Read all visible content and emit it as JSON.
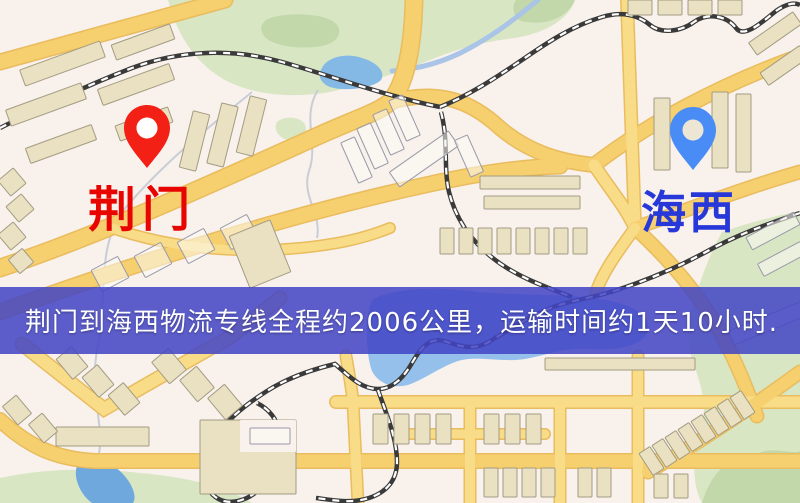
{
  "banner": {
    "text": "荆门到海西物流专线全程约2006公里，运输时间约1天10小时.",
    "bg": "rgba(66,69,197,0.86)"
  },
  "labels": {
    "origin": "荆门",
    "destination": "海西"
  },
  "colors": {
    "bg": "#f8f1ec",
    "origin_label": "#e80500",
    "destination_label": "#2838d8",
    "origin_pin": "#f32015",
    "origin_pin_hole": "#ffffff",
    "destination_pin": "#4a8cf5",
    "destination_pin_hole": "#eee6d4",
    "road_edge": "#e9bc5e",
    "road_main": "#f6cf6e",
    "road_fill": "#f9dc88",
    "rail_dark": "#3a3a3a",
    "rail_light": "#ffffff",
    "green": "#d8e6c4",
    "green_dark": "#c2d8aa",
    "water": "#96c0ec",
    "water_dark": "#6fa8dc",
    "pond": "#84b9e6",
    "river": "#a9c4e6",
    "stream": "#c9cdd6",
    "building": "#eae0c2",
    "building_edge": "#a39c82",
    "building_outline": "#9a99a8",
    "building_outline_fill": "rgba(252,250,244,0.55)"
  },
  "map_features": {
    "green": [
      {
        "d": "M168,0 L575,0 C568,22 540,34 515,38 C480,42 455,50 430,60 C400,72 365,84 330,92 C295,98 255,96 225,80 C200,66 178,40 168,0 Z",
        "fill": "green"
      },
      {
        "d": "M516,0 L575,0 C568,17 546,27 521,21 C512,15 512,5 516,0 Z",
        "fill": "green_dark"
      },
      {
        "d": "M266,20 C280,12 320,12 334,22 C344,30 340,42 322,46 C300,50 272,46 264,36 C260,30 260,25 266,20 Z",
        "fill": "green_dark"
      },
      {
        "d": "M722,232 C750,222 780,215 800,211 L800,503 L702,503 C690,480 694,452 701,430 C709,405 699,380 691,355 C685,332 691,305 701,280 C707,262 714,247 722,232 Z",
        "fill": "green"
      },
      {
        "d": "M702,503 C712,470 731,455 748,462 C764,441 789,456 800,451 L800,503 Z",
        "fill": "green_dark"
      },
      {
        "d": "M0,478 C40,469 90,467 140,473 C185,477 226,486 252,503 L0,503 Z",
        "fill": "green"
      },
      {
        "d": "M277,122 C284,116 298,116 304,123 C309,130 304,139 292,140 C281,141 272,130 277,122 Z",
        "fill": "green"
      }
    ],
    "water": [
      {
        "d": "M372,300 C390,289 430,286 470,291 C510,296 560,293 600,299 C635,304 652,317 648,331 C642,347 615,351 592,349 C565,347 548,355 525,359 C500,363 478,355 458,361 C440,367 425,379 408,385 C392,389 378,383 372,371 C366,355 364,318 372,300 Z",
        "fill": "water"
      },
      {
        "d": "M322,68 C328,56 348,53 362,58 C376,62 386,71 381,80 C371,90 336,92 326,85 C319,80 318,74 322,68 Z",
        "fill": "pond"
      },
      {
        "d": "M78,464 C90,456 110,461 121,472 C133,484 137,497 133,503 L92,503 C79,494 72,474 78,464 Z",
        "fill": "water_dark"
      }
    ],
    "river": {
      "d": "M538,0 C516,18 496,34 468,49 C446,61 420,69 392,71",
      "w": 5
    },
    "streams": [
      {
        "d": "M252,92 C205,130 160,166 122,212 C96,250 108,300 97,350 C89,398 106,428 98,458"
      },
      {
        "d": "M318,90 C301,117 319,144 309,171 C301,196 322,214 317,238"
      }
    ],
    "roads": [
      {
        "d": "M0,62 L225,0",
        "w": 14,
        "main": 1
      },
      {
        "d": "M0,268 C100,235 220,180 320,135 C360,117 380,112 392,100 C408,78 413,40 414,0",
        "w": 16,
        "main": 1
      },
      {
        "d": "M390,102 C440,88 472,102 500,128 C526,150 555,161 594,165",
        "w": 13,
        "main": 1
      },
      {
        "d": "M594,165 C650,122 722,84 800,56",
        "w": 13,
        "main": 1
      },
      {
        "d": "M594,165 C612,192 626,208 635,228",
        "w": 11,
        "main": 0
      },
      {
        "d": "M627,0 L635,228",
        "w": 11,
        "main": 0
      },
      {
        "d": "M635,228 C690,209 750,186 800,172",
        "w": 12,
        "main": 1
      },
      {
        "d": "M635,228 C672,262 700,296 720,332 C738,365 748,392 757,416",
        "w": 12,
        "main": 1
      },
      {
        "d": "M635,228 C616,254 603,272 596,292",
        "w": 10,
        "main": 0
      },
      {
        "d": "M0,312 C150,258 300,212 430,184 C480,173 525,167 560,166",
        "w": 14,
        "main": 1
      },
      {
        "d": "M22,344 L104,409 L230,337 C252,321 266,309 280,298",
        "w": 12,
        "main": 0
      },
      {
        "d": "M0,420 C28,446 55,459 95,461 L800,461",
        "w": 13,
        "main": 1
      },
      {
        "d": "M336,402 L800,402",
        "w": 11,
        "main": 0
      },
      {
        "d": "M346,356 C350,380 352,390 353,402 L358,503",
        "w": 10,
        "main": 0
      },
      {
        "d": "M470,402 L470,503",
        "w": 10,
        "main": 0
      },
      {
        "d": "M560,402 L560,503",
        "w": 10,
        "main": 0
      },
      {
        "d": "M638,356 L638,503",
        "w": 10,
        "main": 0
      },
      {
        "d": "M400,434 L545,434",
        "w": 9,
        "main": 0
      },
      {
        "d": "M648,472 C700,442 748,410 800,372",
        "w": 12,
        "main": 1
      },
      {
        "d": "M112,228 C170,248 235,254 300,248 C340,244 365,238 390,228",
        "w": 9,
        "main": 0
      }
    ],
    "railways": [
      {
        "d": "M0,128 C40,108 85,86 132,68 C180,50 232,48 282,62 C332,76 385,96 440,107"
      },
      {
        "d": "M440,107 C472,94 498,76 522,60 C548,42 572,26 602,17 C622,11 638,15 650,25 C661,34 680,32 694,22 C708,12 727,16 736,28 C744,39 762,22 776,11 C786,4 794,2 800,5"
      },
      {
        "d": "M441,112 C449,142 443,166 449,192 C456,220 472,242 494,259 C517,277 546,287 572,297"
      },
      {
        "d": "M800,213 C768,224 738,234 704,253 C676,268 648,280 614,291 C589,299 564,301 544,311 C521,321 504,333 487,343 C471,351 457,345 444,341 C429,337 420,349 412,363 C404,377 393,389 378,389 C361,389 349,376 335,364 C314,369 289,377 267,391 C245,405 225,421 211,443 C199,463 199,481 213,495 C227,508 248,501 262,487 C276,473 284,453 280,433 C277,419 269,409 257,403"
      },
      {
        "d": "M378,390 C388,418 397,440 397,462 C397,480 387,492 369,498 C351,504 333,500 316,498"
      }
    ],
    "buildings": [
      {
        "x": 20,
        "y": 55,
        "w": 85,
        "h": 17,
        "r": -20,
        "s": "A"
      },
      {
        "x": 112,
        "y": 34,
        "w": 62,
        "h": 16,
        "r": -20,
        "s": "A"
      },
      {
        "x": 6,
        "y": 96,
        "w": 80,
        "h": 17,
        "r": -20,
        "s": "A"
      },
      {
        "x": 98,
        "y": 76,
        "w": 76,
        "h": 17,
        "r": -20,
        "s": "A"
      },
      {
        "x": 26,
        "y": 136,
        "w": 70,
        "h": 16,
        "r": -20,
        "s": "A"
      },
      {
        "x": 116,
        "y": 116,
        "w": 56,
        "h": 16,
        "r": -20,
        "s": "A"
      },
      {
        "x": 2,
        "y": 172,
        "w": 20,
        "h": 20,
        "r": -40,
        "s": "A"
      },
      {
        "x": 10,
        "y": 198,
        "w": 20,
        "h": 20,
        "r": -40,
        "s": "A"
      },
      {
        "x": 2,
        "y": 226,
        "w": 20,
        "h": 20,
        "r": -40,
        "s": "A"
      },
      {
        "x": 12,
        "y": 252,
        "w": 18,
        "h": 18,
        "r": -40,
        "s": "A"
      },
      {
        "x": 186,
        "y": 112,
        "w": 17,
        "h": 58,
        "r": 14,
        "s": "A"
      },
      {
        "x": 214,
        "y": 104,
        "w": 17,
        "h": 62,
        "r": 14,
        "s": "A"
      },
      {
        "x": 243,
        "y": 97,
        "w": 17,
        "h": 58,
        "r": 14,
        "s": "A"
      },
      {
        "x": 349,
        "y": 138,
        "w": 15,
        "h": 44,
        "r": -24,
        "s": "B"
      },
      {
        "x": 365,
        "y": 124,
        "w": 15,
        "h": 44,
        "r": -24,
        "s": "B"
      },
      {
        "x": 381,
        "y": 110,
        "w": 15,
        "h": 44,
        "r": -24,
        "s": "B"
      },
      {
        "x": 397,
        "y": 96,
        "w": 15,
        "h": 44,
        "r": -24,
        "s": "B"
      },
      {
        "x": 388,
        "y": 150,
        "w": 72,
        "h": 18,
        "r": -35,
        "s": "B"
      },
      {
        "x": 462,
        "y": 136,
        "w": 14,
        "h": 40,
        "r": -24,
        "s": "B"
      },
      {
        "x": 480,
        "y": 176,
        "w": 100,
        "h": 13,
        "r": 0,
        "s": "A"
      },
      {
        "x": 484,
        "y": 196,
        "w": 96,
        "h": 13,
        "r": 0,
        "s": "A"
      },
      {
        "x": 440,
        "y": 228,
        "w": 14,
        "h": 26,
        "r": 0,
        "s": "A"
      },
      {
        "x": 459,
        "y": 228,
        "w": 14,
        "h": 26,
        "r": 0,
        "s": "A"
      },
      {
        "x": 478,
        "y": 228,
        "w": 14,
        "h": 26,
        "r": 0,
        "s": "A"
      },
      {
        "x": 497,
        "y": 228,
        "w": 14,
        "h": 26,
        "r": 0,
        "s": "A"
      },
      {
        "x": 516,
        "y": 228,
        "w": 14,
        "h": 26,
        "r": 0,
        "s": "A"
      },
      {
        "x": 535,
        "y": 228,
        "w": 14,
        "h": 26,
        "r": 0,
        "s": "A"
      },
      {
        "x": 554,
        "y": 228,
        "w": 14,
        "h": 26,
        "r": 0,
        "s": "A"
      },
      {
        "x": 573,
        "y": 228,
        "w": 14,
        "h": 26,
        "r": 0,
        "s": "A"
      },
      {
        "x": 654,
        "y": 98,
        "w": 16,
        "h": 72,
        "r": 0,
        "s": "A"
      },
      {
        "x": 712,
        "y": 92,
        "w": 16,
        "h": 76,
        "r": 0,
        "s": "A"
      },
      {
        "x": 736,
        "y": 94,
        "w": 15,
        "h": 78,
        "r": 0,
        "s": "A"
      },
      {
        "x": 628,
        "y": 0,
        "w": 24,
        "h": 15,
        "r": 0,
        "s": "A"
      },
      {
        "x": 658,
        "y": 0,
        "w": 24,
        "h": 15,
        "r": 0,
        "s": "A"
      },
      {
        "x": 688,
        "y": 0,
        "w": 24,
        "h": 15,
        "r": 0,
        "s": "A"
      },
      {
        "x": 718,
        "y": 0,
        "w": 24,
        "h": 15,
        "r": 0,
        "s": "A"
      },
      {
        "x": 748,
        "y": 26,
        "w": 54,
        "h": 15,
        "r": -35,
        "s": "A"
      },
      {
        "x": 760,
        "y": 58,
        "w": 48,
        "h": 15,
        "r": -35,
        "s": "A"
      },
      {
        "x": 746,
        "y": 224,
        "w": 54,
        "h": 14,
        "r": -28,
        "s": "B"
      },
      {
        "x": 758,
        "y": 252,
        "w": 48,
        "h": 14,
        "r": -28,
        "s": "B"
      },
      {
        "x": 728,
        "y": 314,
        "w": 88,
        "h": 15,
        "r": -22,
        "s": "B"
      },
      {
        "x": 545,
        "y": 358,
        "w": 150,
        "h": 12,
        "r": 0,
        "s": "A"
      },
      {
        "x": 645,
        "y": 448,
        "w": 13,
        "h": 26,
        "r": -33,
        "s": "A"
      },
      {
        "x": 658,
        "y": 440,
        "w": 13,
        "h": 26,
        "r": -33,
        "s": "A"
      },
      {
        "x": 671,
        "y": 432,
        "w": 13,
        "h": 26,
        "r": -33,
        "s": "A"
      },
      {
        "x": 684,
        "y": 424,
        "w": 13,
        "h": 26,
        "r": -33,
        "s": "A"
      },
      {
        "x": 697,
        "y": 416,
        "w": 13,
        "h": 26,
        "r": -33,
        "s": "A"
      },
      {
        "x": 710,
        "y": 408,
        "w": 13,
        "h": 26,
        "r": -33,
        "s": "A"
      },
      {
        "x": 723,
        "y": 400,
        "w": 13,
        "h": 26,
        "r": -33,
        "s": "A"
      },
      {
        "x": 736,
        "y": 392,
        "w": 13,
        "h": 26,
        "r": -33,
        "s": "A"
      },
      {
        "x": 373,
        "y": 414,
        "w": 15,
        "h": 30,
        "r": 0,
        "s": "A"
      },
      {
        "x": 394,
        "y": 414,
        "w": 15,
        "h": 30,
        "r": 0,
        "s": "A"
      },
      {
        "x": 415,
        "y": 414,
        "w": 15,
        "h": 30,
        "r": 0,
        "s": "A"
      },
      {
        "x": 436,
        "y": 414,
        "w": 15,
        "h": 30,
        "r": 0,
        "s": "A"
      },
      {
        "x": 484,
        "y": 414,
        "w": 15,
        "h": 30,
        "r": 0,
        "s": "A"
      },
      {
        "x": 505,
        "y": 414,
        "w": 15,
        "h": 30,
        "r": 0,
        "s": "A"
      },
      {
        "x": 526,
        "y": 414,
        "w": 15,
        "h": 30,
        "r": 0,
        "s": "A"
      },
      {
        "x": 484,
        "y": 468,
        "w": 14,
        "h": 29,
        "r": 0,
        "s": "A"
      },
      {
        "x": 503,
        "y": 468,
        "w": 14,
        "h": 29,
        "r": 0,
        "s": "A"
      },
      {
        "x": 522,
        "y": 468,
        "w": 14,
        "h": 29,
        "r": 0,
        "s": "A"
      },
      {
        "x": 541,
        "y": 468,
        "w": 14,
        "h": 29,
        "r": 0,
        "s": "A"
      },
      {
        "x": 578,
        "y": 468,
        "w": 14,
        "h": 29,
        "r": 0,
        "s": "A"
      },
      {
        "x": 597,
        "y": 468,
        "w": 14,
        "h": 29,
        "r": 0,
        "s": "A"
      },
      {
        "x": 654,
        "y": 474,
        "w": 14,
        "h": 24,
        "r": 0,
        "s": "A"
      },
      {
        "x": 674,
        "y": 474,
        "w": 14,
        "h": 24,
        "r": 0,
        "s": "A"
      },
      {
        "x": 200,
        "y": 420,
        "w": 96,
        "h": 74,
        "r": 0,
        "s": "A"
      },
      {
        "x": 240,
        "y": 420,
        "w": 56,
        "h": 32,
        "r": 0,
        "s": "bg"
      },
      {
        "x": 250,
        "y": 428,
        "w": 40,
        "h": 16,
        "r": 0,
        "s": "B"
      },
      {
        "x": 56,
        "y": 427,
        "w": 93,
        "h": 19,
        "r": 0,
        "s": "A"
      },
      {
        "x": 62,
        "y": 350,
        "w": 20,
        "h": 26,
        "r": -40,
        "s": "A"
      },
      {
        "x": 88,
        "y": 368,
        "w": 20,
        "h": 26,
        "r": -40,
        "s": "A"
      },
      {
        "x": 114,
        "y": 386,
        "w": 20,
        "h": 26,
        "r": -40,
        "s": "A"
      },
      {
        "x": 158,
        "y": 352,
        "w": 22,
        "h": 28,
        "r": -40,
        "s": "A"
      },
      {
        "x": 186,
        "y": 370,
        "w": 22,
        "h": 28,
        "r": -40,
        "s": "A"
      },
      {
        "x": 214,
        "y": 388,
        "w": 22,
        "h": 28,
        "r": -40,
        "s": "A"
      },
      {
        "x": 8,
        "y": 398,
        "w": 18,
        "h": 24,
        "r": -40,
        "s": "A"
      },
      {
        "x": 34,
        "y": 416,
        "w": 18,
        "h": 24,
        "r": -40,
        "s": "A"
      },
      {
        "x": 95,
        "y": 262,
        "w": 30,
        "h": 24,
        "r": -28,
        "s": "B"
      },
      {
        "x": 138,
        "y": 248,
        "w": 30,
        "h": 24,
        "r": -28,
        "s": "B"
      },
      {
        "x": 181,
        "y": 234,
        "w": 30,
        "h": 24,
        "r": -28,
        "s": "B"
      },
      {
        "x": 224,
        "y": 220,
        "w": 30,
        "h": 24,
        "r": -28,
        "s": "B"
      },
      {
        "x": 238,
        "y": 226,
        "w": 44,
        "h": 56,
        "r": -22,
        "s": "A"
      }
    ]
  }
}
